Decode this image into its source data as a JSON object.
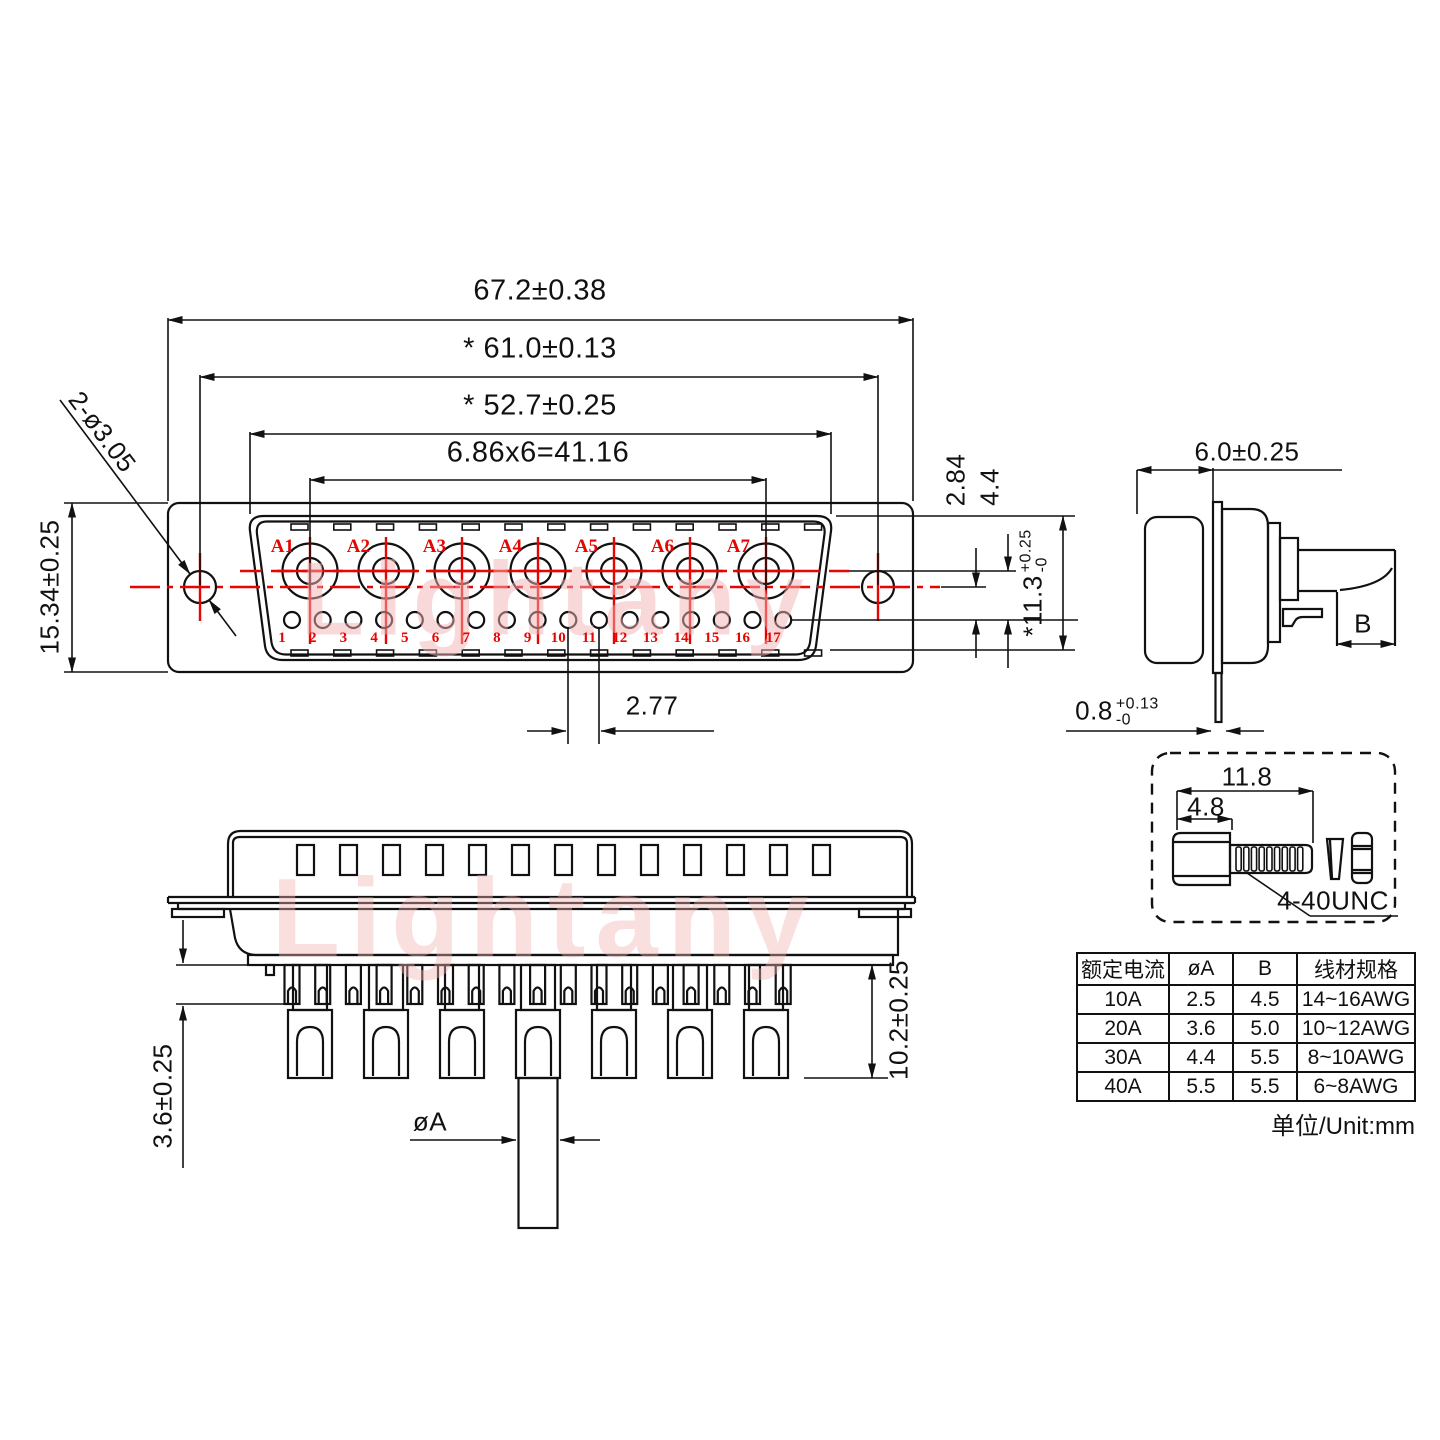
{
  "drawing": {
    "front_view": {
      "dim_width_outer": "67.2±0.38",
      "dim_width_holes": "* 61.0±0.13",
      "dim_width_shell": "* 52.7±0.25",
      "dim_pitch_total": "6.86x6=41.16",
      "dim_mount_holes": "2-ø3.05",
      "dim_flange_height": "15.34±0.25",
      "dim_row_offset": "2.84",
      "dim_row_spacing": "4.4",
      "dim_shell_height": {
        "star": "*",
        "value": "11.3",
        "sup": "+0.25",
        "sub": "-0"
      },
      "dim_pin_pitch": "2.77",
      "contacts": [
        "A1",
        "A2",
        "A3",
        "A4",
        "A5",
        "A6",
        "A7"
      ],
      "pins": [
        "1",
        "2",
        "3",
        "4",
        "5",
        "6",
        "7",
        "8",
        "9",
        "10",
        "11",
        "12",
        "13",
        "14",
        "15",
        "16",
        "17"
      ]
    },
    "side_view": {
      "dim_depth": "6.0±0.25",
      "dim_wire": "B",
      "dim_flange_thickness": {
        "value": "0.8",
        "sup": "+0.13",
        "sub": "-0"
      }
    },
    "bottom_view": {
      "dim_cup": "3.6±0.25",
      "dim_tail": "10.2±0.25",
      "dim_pin_dia": "øA"
    },
    "screw_detail": {
      "dim_total": "11.8",
      "dim_head": "4.8",
      "thread_label": "4-40UNC"
    },
    "watermark": "Lightany"
  },
  "table": {
    "headers": [
      "额定电流",
      "øA",
      "B",
      "线材规格"
    ],
    "rows": [
      [
        "10A",
        "2.5",
        "4.5",
        "14~16AWG"
      ],
      [
        "20A",
        "3.6",
        "5.0",
        "10~12AWG"
      ],
      [
        "30A",
        "4.4",
        "5.5",
        "8~10AWG"
      ],
      [
        "40A",
        "5.5",
        "5.5",
        "6~8AWG"
      ]
    ],
    "unit_label": "单位/Unit:mm"
  }
}
